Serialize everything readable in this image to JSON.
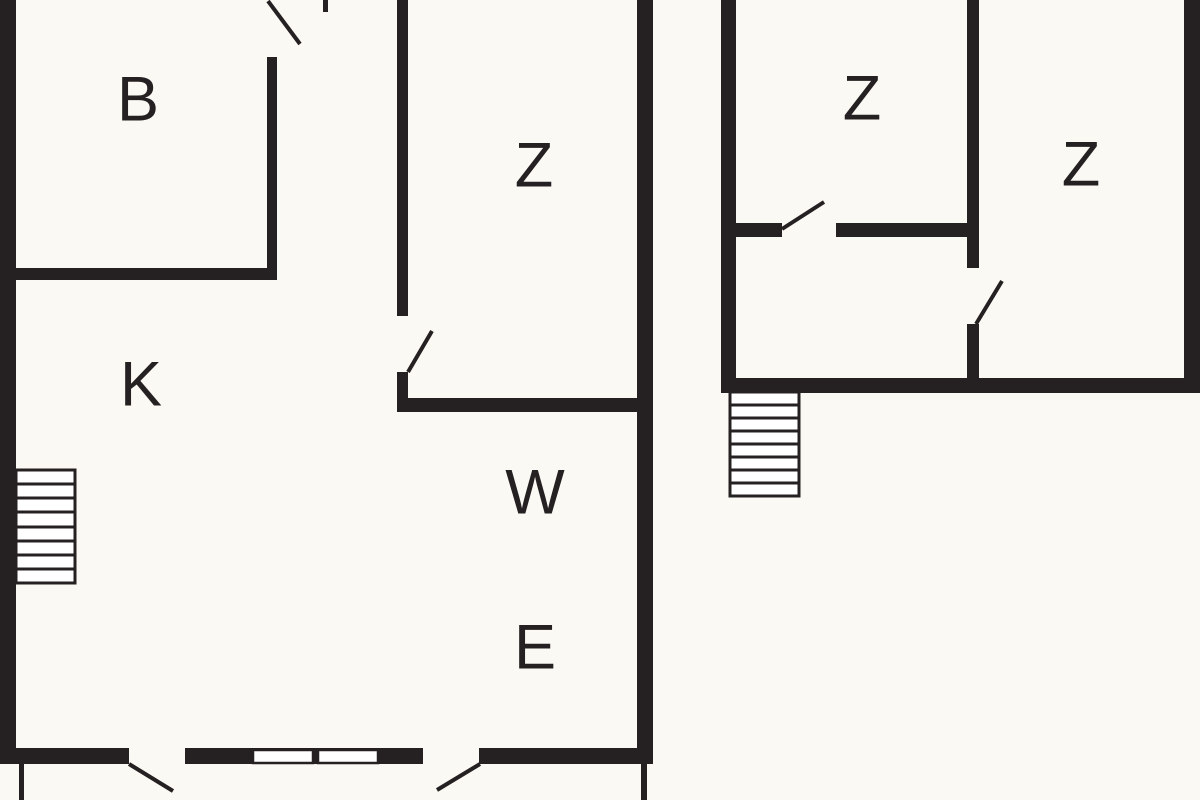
{
  "document": {
    "kind": "floor-plan",
    "floors_visible": 2
  },
  "colors": {
    "background": "#FAF9F3",
    "wall": "#252122",
    "window_fill": "#FFFFFF",
    "label": "#252122"
  },
  "rooms": {
    "b": {
      "label": "B"
    },
    "z_main": {
      "label": "Z"
    },
    "k": {
      "label": "K"
    },
    "w": {
      "label": "W"
    },
    "e": {
      "label": "E"
    },
    "z_annex_front": {
      "label": "Z"
    },
    "z_annex_back": {
      "label": "Z"
    }
  }
}
